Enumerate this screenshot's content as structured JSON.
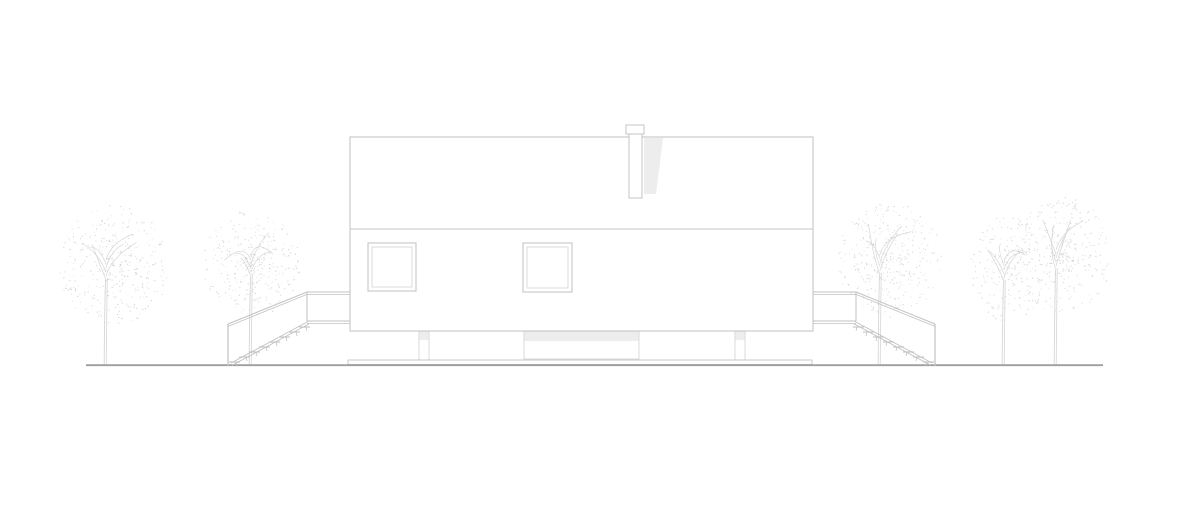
{
  "meta": {
    "type": "architectural-elevation-drawing",
    "description": "Side elevation line drawing of a house with a chimney, two square windows, external stairs with railings on both sides, a raised plinth with piers, and five leafy trees on a single ground line",
    "visible_text": []
  },
  "palette": {
    "background": "#ffffff",
    "outline": "#c5c5c5",
    "outline_soft": "#d7d7d7",
    "stair_line": "#c2c2c2",
    "shadow_fill": "#ededed",
    "ground_line": "#9e9e9e",
    "trunk_line": "#d6d6d6",
    "foliage_dot": "#c9c9c9"
  },
  "scene": {
    "canvas": {
      "width": 1200,
      "height": 507
    },
    "ground": {
      "x1": 86,
      "x2": 1103,
      "y": 365.2,
      "thickness": 1.8
    },
    "slab": {
      "x": 348,
      "y": 360,
      "w": 464,
      "h": 4.5
    },
    "house": {
      "x": 350,
      "y": 137,
      "width": 463,
      "height": 194,
      "eave_y": 229
    },
    "chimney": {
      "cap": {
        "x": 626,
        "y": 125,
        "w": 18,
        "h": 9
      },
      "stack": {
        "x": 629,
        "y": 134,
        "w": 13,
        "h": 64
      },
      "shadow": [
        [
          644,
          138
        ],
        [
          663,
          138
        ],
        [
          656,
          194
        ],
        [
          644,
          194
        ]
      ]
    },
    "windows": [
      {
        "x": 368,
        "y": 243,
        "size": 48,
        "inset": 4
      },
      {
        "x": 523,
        "y": 243,
        "size": 49,
        "inset": 4
      }
    ],
    "piers": [
      {
        "x": 419,
        "y": 331,
        "w": 10,
        "h": 29,
        "cap_h": 9
      },
      {
        "x": 735,
        "y": 331,
        "w": 10,
        "h": 29,
        "cap_h": 9
      }
    ],
    "recess": {
      "x": 524,
      "y": 331,
      "w": 115,
      "h": 28,
      "band_h": 10
    },
    "stairs": {
      "mirror_axis_x": 1163,
      "post": [
        228,
        324,
        228,
        366
      ],
      "rail_diag": [
        228,
        324,
        307,
        292
      ],
      "rail_horiz": [
        307,
        292,
        350,
        292
      ],
      "rail_gap": 2.4,
      "deck_post": [
        307,
        292,
        307,
        321
      ],
      "deck_floor": [
        307,
        321,
        350,
        321
      ],
      "deck_floor_gap": 2.4,
      "stringer": [
        231,
        363,
        308,
        321.5
      ],
      "stringer_gap": 2.4,
      "treads": {
        "count": 8,
        "x0": 229,
        "y0": 362,
        "dx": 10,
        "dy": -5,
        "len": 11,
        "stub_dx": 7,
        "stub_drop": 4
      }
    },
    "trees": [
      {
        "name": "tree-left-outer",
        "trunk_x": 105,
        "cx": 113,
        "cy": 265,
        "rx": 55,
        "ry": 60,
        "dots": 360,
        "seed": 11
      },
      {
        "name": "tree-left-inner",
        "trunk_x": 250,
        "cx": 250,
        "cy": 263,
        "rx": 49,
        "ry": 53,
        "dots": 310,
        "seed": 23
      },
      {
        "name": "tree-right-inner",
        "trunk_x": 879,
        "cx": 889,
        "cy": 260,
        "rx": 53,
        "ry": 58,
        "dots": 340,
        "seed": 37
      },
      {
        "name": "tree-right-outer-a",
        "trunk_x": 1003,
        "cx": 1007,
        "cy": 268,
        "rx": 36,
        "ry": 55,
        "dots": 210,
        "seed": 41
      },
      {
        "name": "tree-right-outer-b",
        "trunk_x": 1055,
        "cx": 1062,
        "cy": 255,
        "rx": 48,
        "ry": 60,
        "dots": 330,
        "seed": 53
      }
    ],
    "tree_base_y": 365
  }
}
